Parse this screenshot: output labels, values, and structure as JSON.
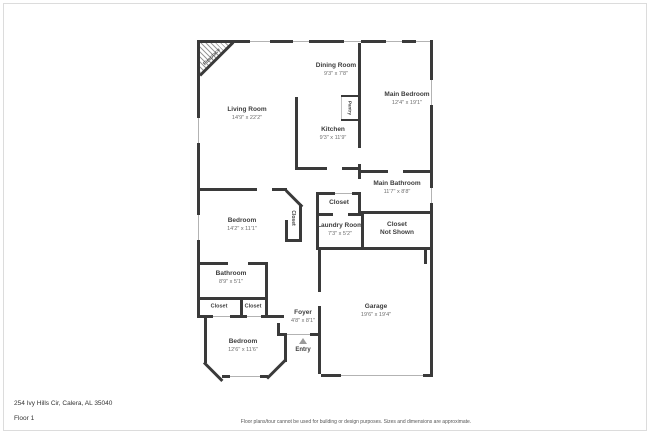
{
  "rooms": {
    "living": {
      "name": "Living Room",
      "dims": "14'9\" x 22'2\""
    },
    "dining": {
      "name": "Dining Room",
      "dims": "9'3\" x 7'8\""
    },
    "kitchen": {
      "name": "Kitchen",
      "dims": "9'3\" x 11'9\""
    },
    "pantry": {
      "name": "Pantry"
    },
    "fireplace": {
      "name": "Fireplace"
    },
    "main_bedroom": {
      "name": "Main Bedroom",
      "dims": "12'4\" x 19'1\""
    },
    "main_bathroom": {
      "name": "Main Bathroom",
      "dims": "11'7\" x 8'8\""
    },
    "hall_closet": {
      "name": "Closet"
    },
    "laundry": {
      "name": "Laundry Room",
      "dims": "7'3\" x 5'2\""
    },
    "closet_not_shown": {
      "name": "Closet",
      "name2": "Not Shown"
    },
    "bedroom1": {
      "name": "Bedroom",
      "dims": "14'2\" x 11'1\""
    },
    "bedroom1_closet": {
      "name": "Closet"
    },
    "bathroom": {
      "name": "Bathroom",
      "dims": "8'9\" x 5'1\""
    },
    "closet_a": {
      "name": "Closet"
    },
    "closet_b": {
      "name": "Closet"
    },
    "foyer": {
      "name": "Foyer",
      "dims": "4'8\" x 8'1\""
    },
    "bedroom2": {
      "name": "Bedroom",
      "dims": "12'6\" x 11'6\""
    },
    "garage": {
      "name": "Garage",
      "dims": "19'6\" x 19'4\""
    },
    "entry": {
      "name": "Entry"
    }
  },
  "footer": {
    "address": "254 Ivy Hills Cir, Calera, AL 35040",
    "floor": "Floor 1",
    "disclaimer": "Floor plans/tour cannot be used for building or design purposes. Sizes and dimensions are approximate."
  },
  "colors": {
    "wall": "#3a3a3a",
    "window": "#b3b3b3",
    "label": "#3d3d3d",
    "dim_text": "#6e6e6e"
  }
}
